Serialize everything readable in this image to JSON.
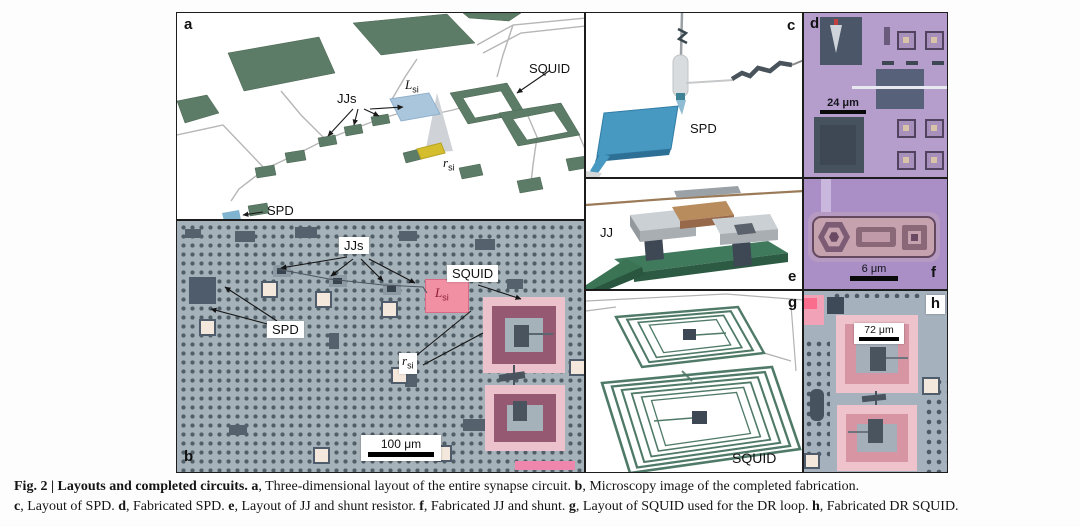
{
  "figure": {
    "panel_a": {
      "letter": "a",
      "label_jjs": "JJs",
      "label_squid": "SQUID",
      "label_spd": "SPD",
      "label_l_main": "L",
      "label_l_sub": "si",
      "label_r_main": "r",
      "label_r_sub": "si",
      "colors": {
        "pad_green": "#5c7c67",
        "inductor_blue": "#a9c6dd",
        "resistor_yellow": "#d4be2e",
        "spd_blue": "#7fb3d0",
        "wire_gray": "#b6b6b6"
      }
    },
    "panel_b": {
      "letter": "b",
      "label_jjs": "JJs",
      "label_squid": "SQUID",
      "label_spd": "SPD",
      "label_l_main": "L",
      "label_l_sub": "si",
      "label_r_main": "r",
      "label_r_sub": "si",
      "scale_bar": "100 μm",
      "colors": {
        "background": "#a6b2b9",
        "l_si_pink": "#f18fa3",
        "loop_outer_pink": "#ecc2cd",
        "loop_ring_mauve": "#955a72",
        "pad_cream": "#f3e8db"
      }
    },
    "panel_c": {
      "letter": "c",
      "label_spd": "SPD",
      "colors": {
        "spd_blue": "#4799c2"
      }
    },
    "panel_d": {
      "letter": "d",
      "scale_bar": "24 μm",
      "colors": {
        "background": "#b59ecb",
        "structure_slate": "#47525f"
      }
    },
    "panel_e": {
      "letter": "e",
      "label_jj": "JJ",
      "colors": {
        "base_green": "#3f7a5c",
        "shunt_tan": "#b98c5e",
        "block_gray": "#cbd0d4"
      }
    },
    "panel_f": {
      "letter": "f",
      "scale_bar": "6 μm",
      "colors": {
        "background": "#a98fc6",
        "junction_body": "#c5a2ad"
      }
    },
    "panel_g": {
      "letter": "g",
      "label_squid": "SQUID",
      "colors": {
        "coil_green": "#4f7a68"
      }
    },
    "panel_h": {
      "letter": "h",
      "scale_bar": "72 μm",
      "colors": {
        "background": "#a5b1bd",
        "loop_pink": "#eec3cb",
        "loop_salmon": "#d795a3"
      }
    }
  },
  "caption": {
    "line1": [
      {
        "t": "Fig. 2 | Layouts and completed circuits. ",
        "b": true
      },
      {
        "t": "a",
        "b": true
      },
      {
        "t": ", Three-dimensional layout of the entire synapse circuit. ",
        "b": false
      },
      {
        "t": "b",
        "b": true
      },
      {
        "t": ", Microscopy image of the completed fabrication.",
        "b": false
      }
    ],
    "line2": [
      {
        "t": "c",
        "b": true
      },
      {
        "t": ", Layout of SPD. ",
        "b": false
      },
      {
        "t": "d",
        "b": true
      },
      {
        "t": ", Fabricated SPD. ",
        "b": false
      },
      {
        "t": "e",
        "b": true
      },
      {
        "t": ", Layout of JJ and shunt resistor. ",
        "b": false
      },
      {
        "t": "f",
        "b": true
      },
      {
        "t": ", Fabricated JJ and shunt. ",
        "b": false
      },
      {
        "t": "g",
        "b": true
      },
      {
        "t": ", Layout of SQUID used for the DR loop. ",
        "b": false
      },
      {
        "t": "h",
        "b": true
      },
      {
        "t": ", Fabricated DR SQUID.",
        "b": false
      }
    ]
  }
}
